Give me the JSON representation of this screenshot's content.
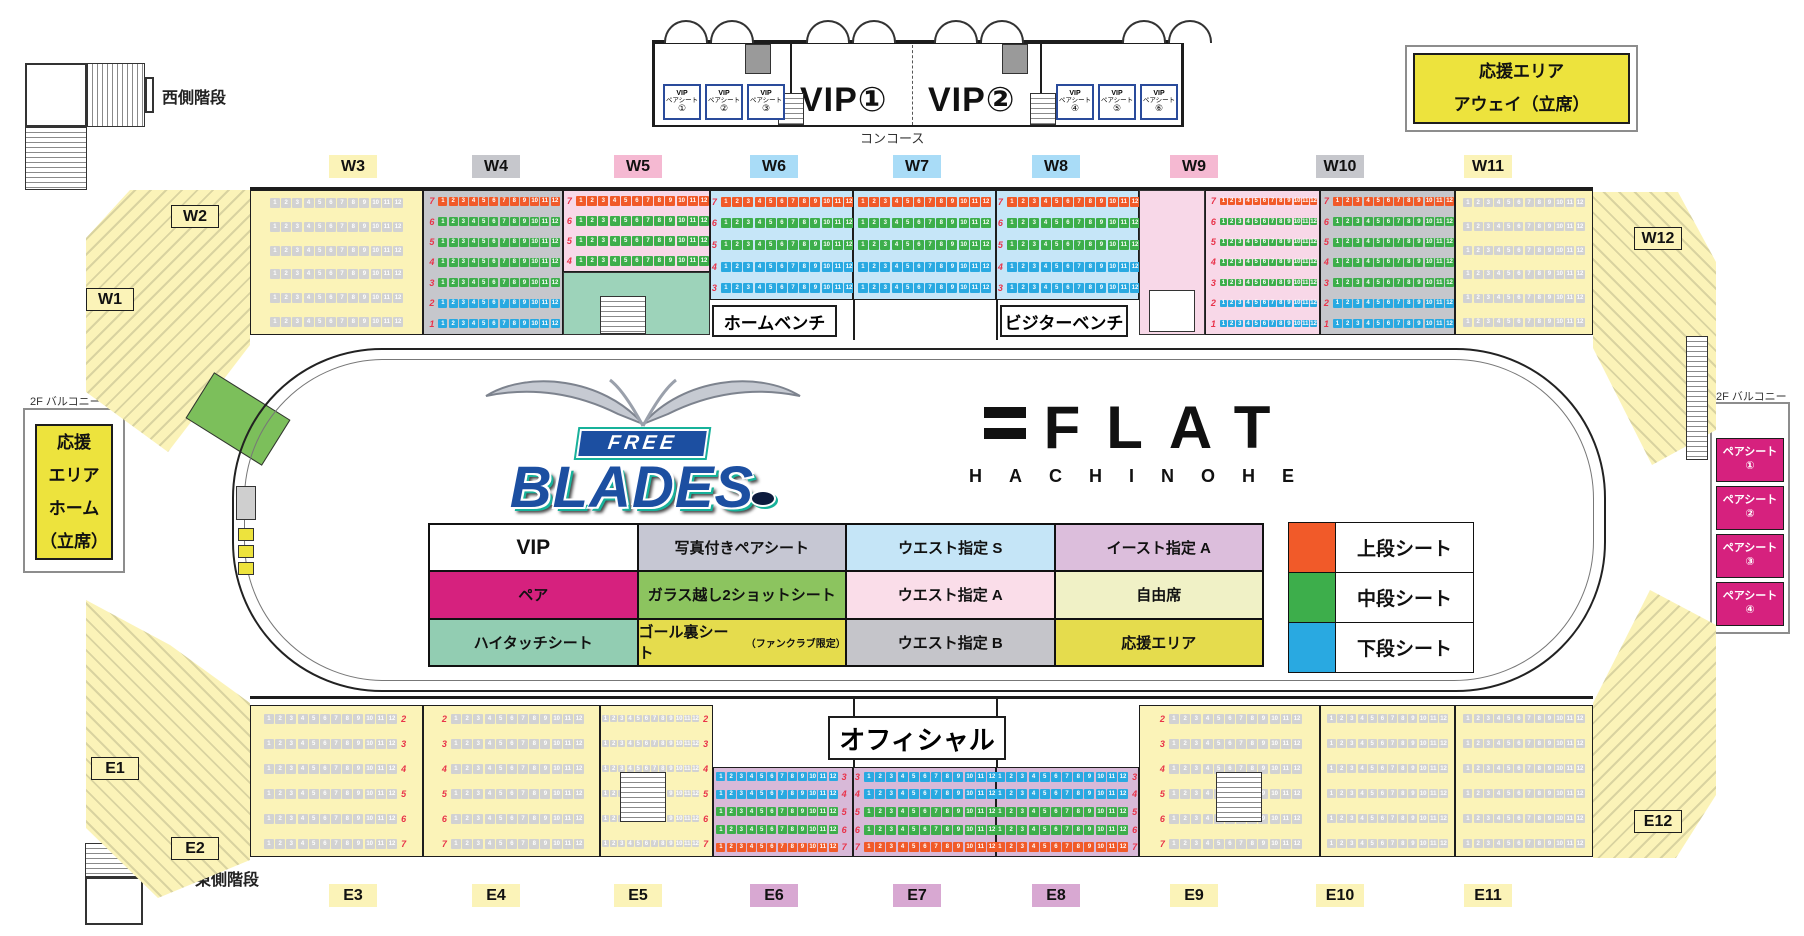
{
  "labels": {
    "west_stairs": "西側階段",
    "east_stairs": "東側階段",
    "concourse": "コンコース",
    "balcony_left": "2F バルコニー",
    "balcony_right": "2F バルコニー",
    "home_bench": "ホームベンチ",
    "visitor_bench": "ビジターベンチ",
    "official": "オフィシャル"
  },
  "vip": {
    "room1": "VIP①",
    "room2": "VIP②",
    "pair_label1": "VIP",
    "pair_label2": "ペアシート",
    "pair_nums": [
      "①",
      "②",
      "③",
      "④",
      "⑤",
      "⑥"
    ]
  },
  "away_area": {
    "line1": "応援エリア",
    "line2": "アウェイ（立席）"
  },
  "home_area": {
    "line1": "応援",
    "line2": "エリア",
    "line3": "ホーム",
    "line4": "（立席）"
  },
  "pair_seats_right": {
    "label": "ペアシート",
    "nums": [
      "①",
      "②",
      "③",
      "④"
    ]
  },
  "team_logo": {
    "top": "FREE",
    "main": "BLADES"
  },
  "arena_logo": {
    "main": "FLAT",
    "sub": "HACHINOHE"
  },
  "tier_legend": [
    {
      "label": "上段シート",
      "color": "#F15A29"
    },
    {
      "label": "中段シート",
      "color": "#3DAE4B"
    },
    {
      "label": "下段シート",
      "color": "#29A9E1"
    }
  ],
  "legend_table": {
    "rows": [
      [
        {
          "label": "VIP",
          "bg": "#FFFFFF",
          "big": true
        },
        {
          "label": "写真付きペアシート",
          "bg": "#C6C7D3"
        },
        {
          "label": "ウエスト指定 S",
          "bg": "#C5E5F7"
        },
        {
          "label": "イースト指定 A",
          "bg": "#DCBEDC"
        }
      ],
      [
        {
          "label": "ペア",
          "bg": "#D6217E"
        },
        {
          "label": "ガラス越し2ショットシート",
          "bg": "#8CC45F"
        },
        {
          "label": "ウエスト指定 A",
          "bg": "#FADDE9"
        },
        {
          "label": "自由席",
          "bg": "#F0F1C6"
        }
      ],
      [
        {
          "label": "ハイタッチシート",
          "bg": "#92CDB2"
        },
        {
          "label": "ゴール裏シート",
          "note": "（ファンクラブ限定）",
          "bg": "#E5DC4D"
        },
        {
          "label": "ウエスト指定 B",
          "bg": "#C5C5CA"
        },
        {
          "label": "応援エリア",
          "bg": "#E5DC4D"
        }
      ]
    ]
  },
  "sections": [
    {
      "id": "W1",
      "label": "W1",
      "x": 86,
      "y": 288,
      "bg": "#FBF3B8",
      "border": true
    },
    {
      "id": "W2",
      "label": "W2",
      "x": 171,
      "y": 205,
      "bg": "#FBF3B8",
      "border": true
    },
    {
      "id": "W3",
      "label": "W3",
      "x": 329,
      "y": 155,
      "bg": "#FBF3B8",
      "border": false
    },
    {
      "id": "W4",
      "label": "W4",
      "x": 472,
      "y": 155,
      "bg": "#C6C7CC",
      "border": false
    },
    {
      "id": "W5",
      "label": "W5",
      "x": 614,
      "y": 155,
      "bg": "#F5B9D2",
      "border": false
    },
    {
      "id": "W6",
      "label": "W6",
      "x": 750,
      "y": 155,
      "bg": "#A9DCF7",
      "border": false
    },
    {
      "id": "W7",
      "label": "W7",
      "x": 893,
      "y": 155,
      "bg": "#A9DCF7",
      "border": false
    },
    {
      "id": "W8",
      "label": "W8",
      "x": 1032,
      "y": 155,
      "bg": "#A9DCF7",
      "border": false
    },
    {
      "id": "W9",
      "label": "W9",
      "x": 1170,
      "y": 155,
      "bg": "#F5B9D2",
      "border": false
    },
    {
      "id": "W10",
      "label": "W10",
      "x": 1316,
      "y": 155,
      "bg": "#C6C7CC",
      "border": false
    },
    {
      "id": "W11",
      "label": "W11",
      "x": 1464,
      "y": 155,
      "bg": "#FBF3B8",
      "border": false
    },
    {
      "id": "W12",
      "label": "W12",
      "x": 1634,
      "y": 227,
      "bg": "#FBF3B8",
      "border": true
    },
    {
      "id": "E1",
      "label": "E1",
      "x": 91,
      "y": 757,
      "bg": "#FBF3B8",
      "border": true
    },
    {
      "id": "E2",
      "label": "E2",
      "x": 171,
      "y": 837,
      "bg": "#FBF3B8",
      "border": true
    },
    {
      "id": "E3",
      "label": "E3",
      "x": 329,
      "y": 884,
      "bg": "#FBF3B8",
      "border": false
    },
    {
      "id": "E4",
      "label": "E4",
      "x": 472,
      "y": 884,
      "bg": "#FBF3B8",
      "border": false
    },
    {
      "id": "E5",
      "label": "E5",
      "x": 614,
      "y": 884,
      "bg": "#FBF3B8",
      "border": false
    },
    {
      "id": "E6",
      "label": "E6",
      "x": 750,
      "y": 884,
      "bg": "#D8A8D2",
      "border": false
    },
    {
      "id": "E7",
      "label": "E7",
      "x": 893,
      "y": 884,
      "bg": "#D8A8D2",
      "border": false
    },
    {
      "id": "E8",
      "label": "E8",
      "x": 1032,
      "y": 884,
      "bg": "#D8A8D2",
      "border": false
    },
    {
      "id": "E9",
      "label": "E9",
      "x": 1170,
      "y": 884,
      "bg": "#FBF3B8",
      "border": false
    },
    {
      "id": "E10",
      "label": "E10",
      "x": 1316,
      "y": 884,
      "bg": "#FBF3B8",
      "border": false
    },
    {
      "id": "E11",
      "label": "E11",
      "x": 1464,
      "y": 884,
      "bg": "#FBF3B8",
      "border": false
    },
    {
      "id": "E12",
      "label": "E12",
      "x": 1634,
      "y": 810,
      "bg": "#FBF3B8",
      "border": true
    }
  ],
  "seat_blocks": [
    {
      "id": "w3",
      "x": 250,
      "y": 190,
      "w": 173,
      "h": 145,
      "bg": "#FBF3B8",
      "num": null,
      "rows": [
        {
          "n": "",
          "t": "f"
        },
        {
          "n": "",
          "t": "f"
        },
        {
          "n": "",
          "t": "f"
        },
        {
          "n": "",
          "t": "f"
        },
        {
          "n": "",
          "t": "f"
        },
        {
          "n": "",
          "t": "f"
        }
      ]
    },
    {
      "id": "w4",
      "x": 423,
      "y": 190,
      "w": 140,
      "h": 145,
      "bg": "#C6C7CC",
      "num": "left",
      "rows": [
        {
          "n": "7",
          "t": "u"
        },
        {
          "n": "6",
          "t": "m"
        },
        {
          "n": "5",
          "t": "m"
        },
        {
          "n": "4",
          "t": "m"
        },
        {
          "n": "3",
          "t": "m"
        },
        {
          "n": "2",
          "t": "l"
        },
        {
          "n": "1",
          "t": "l"
        }
      ]
    },
    {
      "id": "w5",
      "x": 563,
      "y": 190,
      "w": 147,
      "h": 82,
      "bg": "#F8D8E8",
      "num": "left",
      "rows": [
        {
          "n": "7",
          "t": "u"
        },
        {
          "n": "6",
          "t": "m"
        },
        {
          "n": "5",
          "t": "m"
        },
        {
          "n": "4",
          "t": "m"
        }
      ]
    },
    {
      "id": "w6",
      "x": 710,
      "y": 190,
      "w": 143,
      "h": 110,
      "bg": "#C6E6F8",
      "num": "left",
      "rows": [
        {
          "n": "7",
          "t": "u"
        },
        {
          "n": "6",
          "t": "m"
        },
        {
          "n": "5",
          "t": "m"
        },
        {
          "n": "4",
          "t": "l"
        },
        {
          "n": "3",
          "t": "l"
        }
      ]
    },
    {
      "id": "w7",
      "x": 853,
      "y": 190,
      "w": 143,
      "h": 110,
      "bg": "#C6E6F8",
      "num": null,
      "rows": [
        {
          "n": "7",
          "t": "u"
        },
        {
          "n": "6",
          "t": "m"
        },
        {
          "n": "5",
          "t": "m"
        },
        {
          "n": "4",
          "t": "l"
        },
        {
          "n": "3",
          "t": "l"
        }
      ]
    },
    {
      "id": "w8",
      "x": 996,
      "y": 190,
      "w": 143,
      "h": 110,
      "bg": "#C6E6F8",
      "num": "left",
      "rows": [
        {
          "n": "7",
          "t": "u"
        },
        {
          "n": "6",
          "t": "m"
        },
        {
          "n": "5",
          "t": "m"
        },
        {
          "n": "4",
          "t": "l"
        },
        {
          "n": "3",
          "t": "l"
        }
      ]
    },
    {
      "id": "w9",
      "x": 1205,
      "y": 190,
      "w": 115,
      "h": 145,
      "bg": "#F8D8E8",
      "num": "left",
      "rows": [
        {
          "n": "7",
          "t": "u"
        },
        {
          "n": "6",
          "t": "m"
        },
        {
          "n": "5",
          "t": "m"
        },
        {
          "n": "4",
          "t": "m"
        },
        {
          "n": "3",
          "t": "m"
        },
        {
          "n": "2",
          "t": "l"
        },
        {
          "n": "1",
          "t": "l"
        }
      ]
    },
    {
      "id": "w10",
      "x": 1320,
      "y": 190,
      "w": 135,
      "h": 145,
      "bg": "#C6C7CC",
      "num": "left",
      "rows": [
        {
          "n": "7",
          "t": "u"
        },
        {
          "n": "6",
          "t": "m"
        },
        {
          "n": "5",
          "t": "m"
        },
        {
          "n": "4",
          "t": "m"
        },
        {
          "n": "3",
          "t": "m"
        },
        {
          "n": "2",
          "t": "l"
        },
        {
          "n": "1",
          "t": "l"
        }
      ]
    },
    {
      "id": "w11",
      "x": 1455,
      "y": 190,
      "w": 138,
      "h": 145,
      "bg": "#FBF3B8",
      "num": null,
      "rows": [
        {
          "n": "",
          "t": "f"
        },
        {
          "n": "",
          "t": "f"
        },
        {
          "n": "",
          "t": "f"
        },
        {
          "n": "",
          "t": "f"
        },
        {
          "n": "",
          "t": "f"
        },
        {
          "n": "",
          "t": "f"
        }
      ]
    },
    {
      "id": "e3",
      "x": 250,
      "y": 705,
      "w": 173,
      "h": 152,
      "bg": "#FBF3B8",
      "num": "right",
      "rows": [
        {
          "n": "2",
          "t": "f"
        },
        {
          "n": "3",
          "t": "f"
        },
        {
          "n": "4",
          "t": "f"
        },
        {
          "n": "5",
          "t": "f"
        },
        {
          "n": "6",
          "t": "f"
        },
        {
          "n": "7",
          "t": "f"
        }
      ]
    },
    {
      "id": "e4",
      "x": 423,
      "y": 705,
      "w": 177,
      "h": 152,
      "bg": "#FBF3B8",
      "num": "left",
      "rows": [
        {
          "n": "2",
          "t": "f"
        },
        {
          "n": "3",
          "t": "f"
        },
        {
          "n": "4",
          "t": "f"
        },
        {
          "n": "5",
          "t": "f"
        },
        {
          "n": "6",
          "t": "f"
        },
        {
          "n": "7",
          "t": "f"
        }
      ]
    },
    {
      "id": "e5",
      "x": 600,
      "y": 705,
      "w": 113,
      "h": 152,
      "bg": "#FBF3B8",
      "num": "right",
      "rows": [
        {
          "n": "2",
          "t": "f"
        },
        {
          "n": "3",
          "t": "f"
        },
        {
          "n": "4",
          "t": "f"
        },
        {
          "n": "5",
          "t": "f"
        },
        {
          "n": "6",
          "t": "f"
        },
        {
          "n": "7",
          "t": "f"
        }
      ]
    },
    {
      "id": "e6",
      "x": 713,
      "y": 767,
      "w": 140,
      "h": 90,
      "bg": "#D8B9D8",
      "num": "right",
      "rows": [
        {
          "n": "3",
          "t": "l"
        },
        {
          "n": "4",
          "t": "l"
        },
        {
          "n": "5",
          "t": "m"
        },
        {
          "n": "6",
          "t": "m"
        },
        {
          "n": "7",
          "t": "u"
        }
      ]
    },
    {
      "id": "e7",
      "x": 853,
      "y": 767,
      "w": 143,
      "h": 90,
      "bg": "#D8B9D8",
      "num": "left",
      "rows": [
        {
          "n": "3",
          "t": "l"
        },
        {
          "n": "4",
          "t": "l"
        },
        {
          "n": "5",
          "t": "m"
        },
        {
          "n": "6",
          "t": "m"
        },
        {
          "n": "7",
          "t": "u"
        }
      ]
    },
    {
      "id": "e8",
      "x": 996,
      "y": 767,
      "w": 143,
      "h": 90,
      "bg": "#D8B9D8",
      "num": "right",
      "rows": [
        {
          "n": "3",
          "t": "l"
        },
        {
          "n": "4",
          "t": "l"
        },
        {
          "n": "5",
          "t": "m"
        },
        {
          "n": "6",
          "t": "m"
        },
        {
          "n": "7",
          "t": "u"
        }
      ]
    },
    {
      "id": "e9",
      "x": 1139,
      "y": 705,
      "w": 181,
      "h": 152,
      "bg": "#FBF3B8",
      "num": "left",
      "rows": [
        {
          "n": "2",
          "t": "f"
        },
        {
          "n": "3",
          "t": "f"
        },
        {
          "n": "4",
          "t": "f"
        },
        {
          "n": "5",
          "t": "f"
        },
        {
          "n": "6",
          "t": "f"
        },
        {
          "n": "7",
          "t": "f"
        }
      ]
    },
    {
      "id": "e10",
      "x": 1320,
      "y": 705,
      "w": 135,
      "h": 152,
      "bg": "#FBF3B8",
      "num": null,
      "rows": [
        {
          "n": "2",
          "t": "f"
        },
        {
          "n": "3",
          "t": "f"
        },
        {
          "n": "4",
          "t": "f"
        },
        {
          "n": "5",
          "t": "f"
        },
        {
          "n": "6",
          "t": "f"
        },
        {
          "n": "7",
          "t": "f"
        }
      ]
    },
    {
      "id": "e11",
      "x": 1455,
      "y": 705,
      "w": 138,
      "h": 152,
      "bg": "#FBF3B8",
      "num": null,
      "rows": [
        {
          "n": "2",
          "t": "f"
        },
        {
          "n": "3",
          "t": "f"
        },
        {
          "n": "4",
          "t": "f"
        },
        {
          "n": "5",
          "t": "f"
        },
        {
          "n": "6",
          "t": "f"
        },
        {
          "n": "7",
          "t": "f"
        }
      ]
    }
  ],
  "fixtures": [
    {
      "id": "hitouch-area",
      "x": 563,
      "y": 272,
      "w": 147,
      "h": 63,
      "bg": "#9DD3BA",
      "type": "plain"
    },
    {
      "id": "pair-room",
      "x": 1139,
      "y": 190,
      "w": 66,
      "h": 145,
      "bg": "#F8D8E8",
      "type": "plain"
    },
    {
      "id": "pair-room-inner",
      "x": 1149,
      "y": 290,
      "w": 46,
      "h": 42,
      "bg": "#FFFFFF",
      "type": "plain"
    },
    {
      "id": "door-block-left",
      "x": 745,
      "y": 44,
      "w": 26,
      "h": 30,
      "bg": "#9A9A9A",
      "type": "plain"
    },
    {
      "id": "door-block-right",
      "x": 1002,
      "y": 44,
      "w": 26,
      "h": 30,
      "bg": "#9A9A9A",
      "type": "plain"
    },
    {
      "id": "stairs-vip-left",
      "x": 778,
      "y": 93,
      "w": 26,
      "h": 32,
      "bg": "",
      "type": "stairs"
    },
    {
      "id": "stairs-vip-right",
      "x": 1030,
      "y": 93,
      "w": 26,
      "h": 32,
      "bg": "",
      "type": "stairs"
    },
    {
      "id": "stairs-w5",
      "x": 600,
      "y": 296,
      "w": 46,
      "h": 38,
      "bg": "",
      "type": "stairs"
    },
    {
      "id": "stairs-e5",
      "x": 620,
      "y": 772,
      "w": 46,
      "h": 50,
      "bg": "",
      "type": "stairs"
    },
    {
      "id": "stairs-e9",
      "x": 1216,
      "y": 772,
      "w": 46,
      "h": 50,
      "bg": "",
      "type": "stairs"
    },
    {
      "id": "balcony-ladder",
      "x": 1686,
      "y": 336,
      "w": 22,
      "h": 124,
      "bg": "",
      "type": "stairs"
    },
    {
      "id": "scoreboard-box",
      "x": 236,
      "y": 486,
      "w": 20,
      "h": 34,
      "bg": "#CFCFCF",
      "type": "plain"
    },
    {
      "id": "goal-box-1",
      "x": 238,
      "y": 528,
      "w": 16,
      "h": 13,
      "bg": "#EDE33D",
      "type": "plain"
    },
    {
      "id": "goal-box-2",
      "x": 238,
      "y": 545,
      "w": 16,
      "h": 13,
      "bg": "#EDE33D",
      "type": "plain"
    },
    {
      "id": "goal-box-3",
      "x": 238,
      "y": 562,
      "w": 16,
      "h": 13,
      "bg": "#EDE33D",
      "type": "plain"
    }
  ],
  "door_arcs": [
    664,
    710,
    806,
    852,
    934,
    980,
    1122,
    1168
  ]
}
